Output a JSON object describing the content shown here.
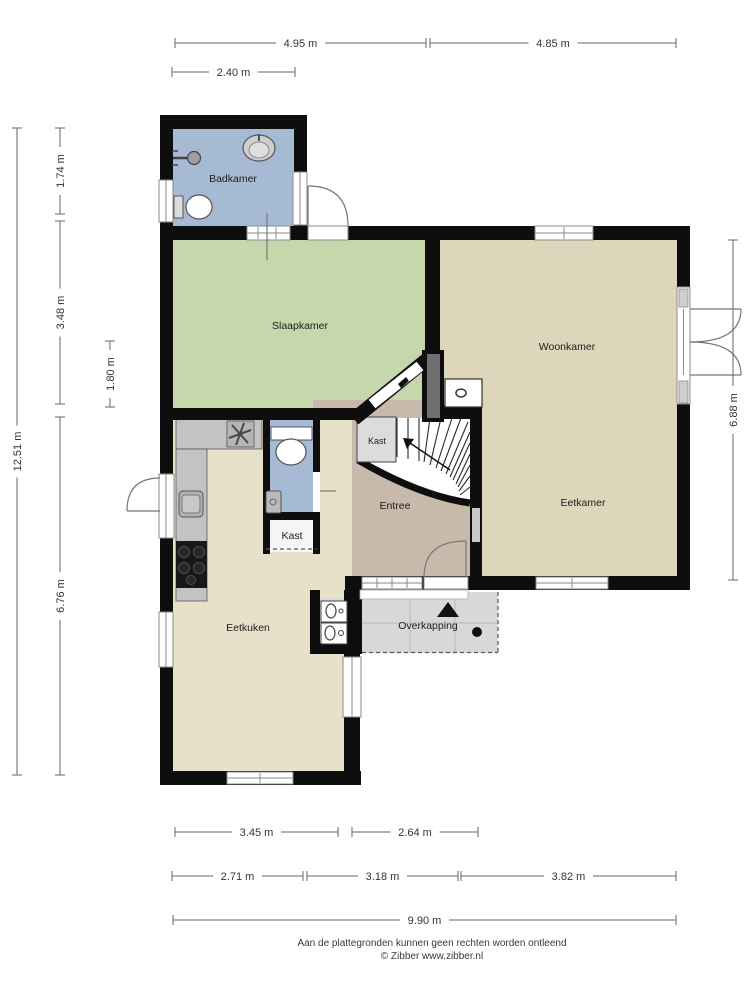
{
  "rooms": {
    "badkamer": {
      "label": "Badkamer"
    },
    "slaapkamer": {
      "label": "Slaapkamer"
    },
    "woonkamer": {
      "label": "Woonkamer"
    },
    "eetkamer": {
      "label": "Eetkamer"
    },
    "entree": {
      "label": "Entree"
    },
    "eetkuken": {
      "label": "Eetkuken"
    },
    "overkapping": {
      "label": "Overkapping"
    },
    "kast_understairs": {
      "label": "Kast"
    },
    "kast_hal": {
      "label": "Kast"
    }
  },
  "dimensions": {
    "top": [
      {
        "label": "4.95 m"
      },
      {
        "label": "4.85 m"
      },
      {
        "label": "2.40 m"
      }
    ],
    "bottom": [
      {
        "label": "3.45 m"
      },
      {
        "label": "2.64 m"
      },
      {
        "label": "2.71 m"
      },
      {
        "label": "3.18 m"
      },
      {
        "label": "3.82 m"
      },
      {
        "label": "9.90 m"
      }
    ],
    "left": [
      {
        "label": "12.51 m"
      },
      {
        "label": "1.74 m"
      },
      {
        "label": "3.48 m"
      },
      {
        "label": "6.76 m"
      },
      {
        "label": "1.80 m"
      }
    ],
    "right": [
      {
        "label": "6.88 m"
      }
    ]
  },
  "footer": {
    "disclaimer": "Aan de plattegronden kunnen geen rechten worden ontleend",
    "copyright": "© Zibber www.zibber.nl"
  },
  "icons": {
    "north_arrow": "triangle-up",
    "stair_direction": "arrow-up-stairs",
    "bath_sink": "oval-sink",
    "shower_head": "shower",
    "toilet": "toilet",
    "hob": "4-burner-hob",
    "extractor_fan": "fan-asterisk",
    "washer_dryer": "laundry-appliances"
  },
  "colors": {
    "wall": "#0e0e0e",
    "badkamer": "#a7bad4",
    "toilet": "#a7bad4",
    "slaapkamer": "#c5d8ac",
    "woonkamer_eetkamer": "#ded6ba",
    "entree": "#c9b9ab",
    "eetkuken": "#e8e1c9",
    "overkapping": "#d8d8d8",
    "niche": "#d8d8d8",
    "kast": "#dcdcdc",
    "kast_hal": "#f5f5f5",
    "counter": "#c3c3c3",
    "chimney": "#6f6f6f"
  }
}
